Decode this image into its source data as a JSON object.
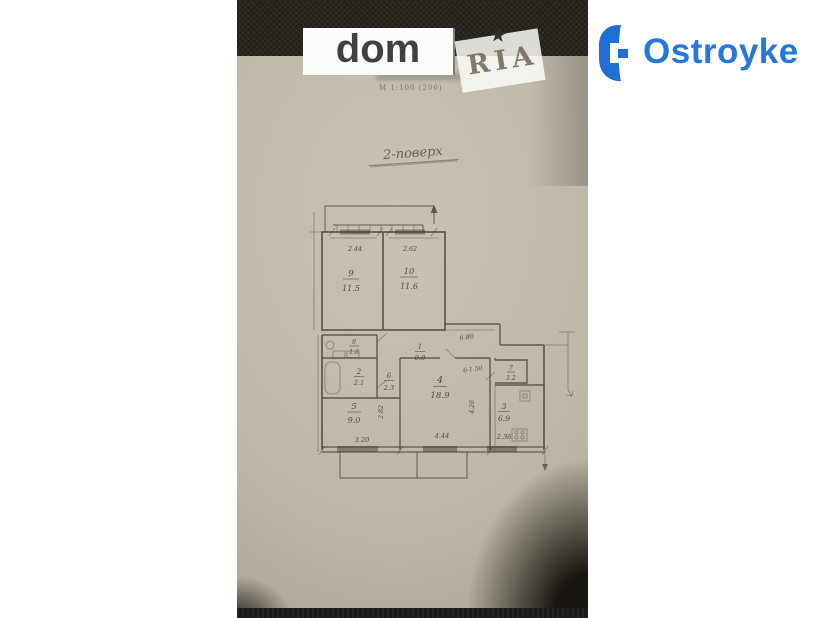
{
  "watermark": {
    "dom_text": "dom",
    "ria_text": "RIA"
  },
  "brand": {
    "name": "Ostroyke",
    "color": "#2677db"
  },
  "icons": {
    "ria_star": "★"
  },
  "photo": {
    "scale_note": "М 1:100 (200)",
    "floor_title": "2-поверх",
    "plan": {
      "rooms": {
        "r9": {
          "num": "9",
          "area": "11.5"
        },
        "r10": {
          "num": "10",
          "area": "11.6"
        },
        "r1": {
          "num": "1",
          "area": "0.9"
        },
        "r8": {
          "num": "8",
          "area": "1.6"
        },
        "r2": {
          "num": "2",
          "area": "2.1"
        },
        "r6": {
          "num": "6",
          "area": "2.3"
        },
        "r4": {
          "num": "4",
          "area": "18.9"
        },
        "r7": {
          "num": "7",
          "area": "1.2"
        },
        "r3": {
          "num": "3",
          "area": "6.9"
        },
        "r5": {
          "num": "5",
          "area": "9.0"
        }
      },
      "dims": {
        "room9_width": "2.44",
        "room10_width": "2.62",
        "hall_length": "6.80",
        "door_note": "6-1.50",
        "left_height": "2.82",
        "right_height": "4.26",
        "bottom_left": "3.20",
        "bottom_middle": "4.44",
        "bottom_right": "2.36"
      }
    }
  }
}
